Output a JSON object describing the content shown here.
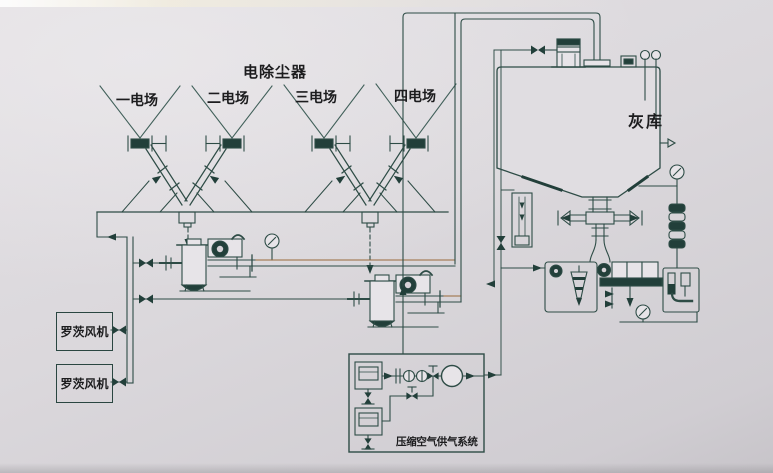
{
  "diagram": {
    "title": "电除尘器",
    "field_labels": [
      "一电场",
      "二电场",
      "三电场",
      "四电场"
    ],
    "silo_label": "灰库",
    "blower_labels": [
      "罗茨风机",
      "罗茨风机"
    ],
    "air_system_label": "压缩空气供气系统",
    "colors": {
      "background": "#dbd8dc",
      "line": "#2e4c46",
      "dark_fill": "#223f3a",
      "pipe_accent": "#9a6a3c",
      "text": "#1c1c1e"
    }
  }
}
